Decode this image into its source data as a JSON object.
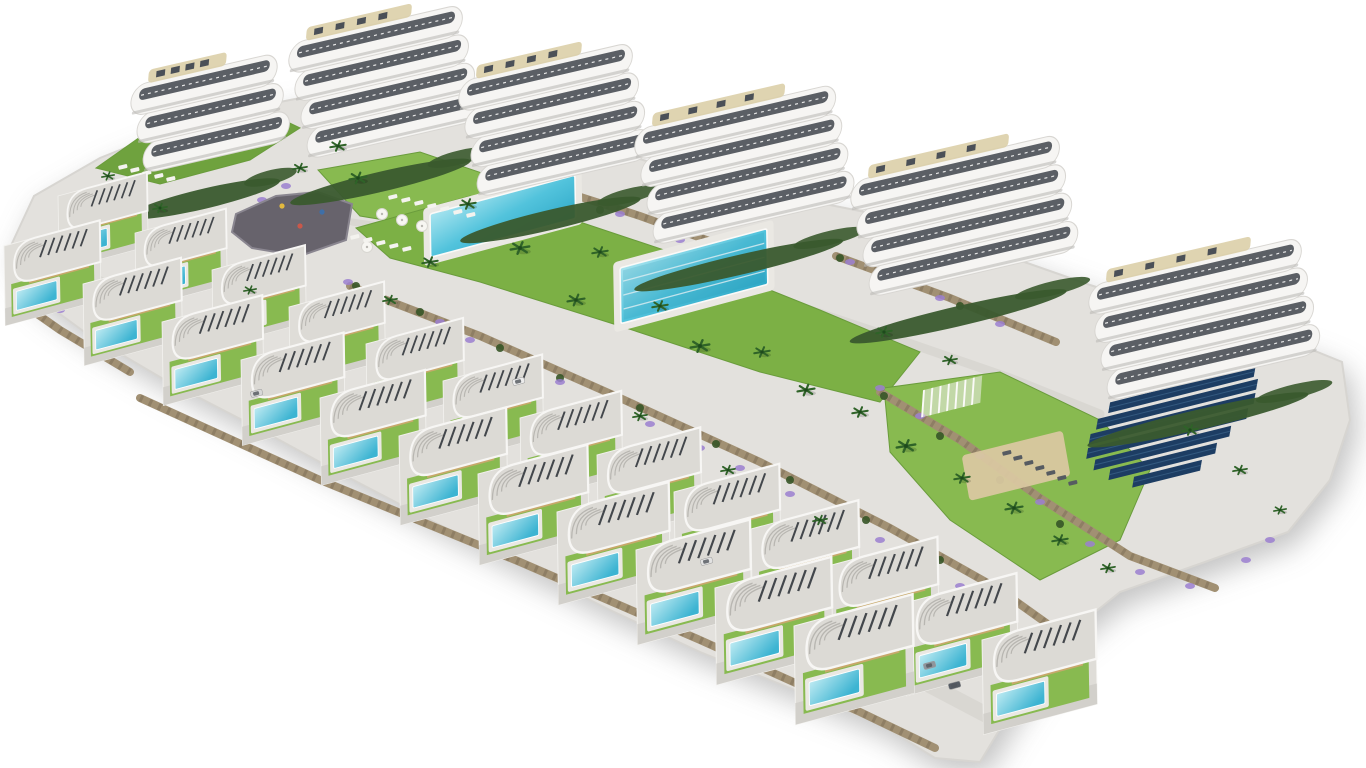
{
  "scene": {
    "name": "aerial-render-residential-resort-complex",
    "background": "#ffffff",
    "colors": {
      "terrain": "#e3e1dd",
      "terrain_edge": "#d7d5d1",
      "road": "#d9d7d2",
      "path": "#e7e5e1",
      "lawn": "#7cb045",
      "lawn_bright": "#88ba50",
      "lawn_slope": "#6fa23e",
      "hedge": "#3a5a2e",
      "palm": "#2f6328",
      "shrub": "#365527",
      "flower": "#9b7fd0",
      "wall": "#a19073",
      "wall_dark": "#7f7058",
      "slab_white": "#f6f5f3",
      "slab_stroke": "#d8d6d2",
      "window_dark": "#454a51",
      "roof_deck": "#dccfa8",
      "villa_roof": "#dcdad5",
      "villa_roof_rim": "#f7f6f4",
      "villa_wall": "#c7a86b",
      "villa_plot": "#dfddd8",
      "villa_drive": "#d2d0cb",
      "louvre": "#43474c",
      "pool_light": "#a8e4ef",
      "pool_mid": "#52c3dc",
      "pool_deep": "#2fa9c8",
      "pool_deck": "#eae8e3",
      "plaza": "#67636c",
      "sand": "#d9c7a0",
      "solar": "#1d3d63",
      "solar_line": "#33597f"
    },
    "terrain_outline": [
      [
        8,
        252
      ],
      [
        34,
        196
      ],
      [
        100,
        158
      ],
      [
        150,
        138
      ],
      [
        230,
        112
      ],
      [
        310,
        96
      ],
      [
        400,
        96
      ],
      [
        480,
        120
      ],
      [
        575,
        140
      ],
      [
        660,
        165
      ],
      [
        780,
        195
      ],
      [
        880,
        215
      ],
      [
        990,
        250
      ],
      [
        1090,
        285
      ],
      [
        1200,
        320
      ],
      [
        1300,
        345
      ],
      [
        1342,
        362
      ],
      [
        1350,
        420
      ],
      [
        1330,
        480
      ],
      [
        1288,
        532
      ],
      [
        1205,
        562
      ],
      [
        1120,
        592
      ],
      [
        1058,
        642
      ],
      [
        1010,
        712
      ],
      [
        980,
        762
      ],
      [
        935,
        758
      ],
      [
        880,
        724
      ],
      [
        790,
        688
      ],
      [
        700,
        652
      ],
      [
        610,
        610
      ],
      [
        520,
        565
      ],
      [
        430,
        520
      ],
      [
        340,
        473
      ],
      [
        250,
        424
      ],
      [
        165,
        380
      ],
      [
        90,
        336
      ],
      [
        30,
        292
      ]
    ],
    "roads": [
      {
        "name": "villa-street",
        "width": 16,
        "points": [
          [
            55,
            262
          ],
          [
            210,
            340
          ],
          [
            400,
            432
          ],
          [
            590,
            522
          ],
          [
            770,
            608
          ],
          [
            905,
            672
          ],
          [
            1000,
            722
          ]
        ]
      },
      {
        "name": "garden-path",
        "width": 9,
        "points": [
          [
            300,
            196
          ],
          [
            420,
            196
          ],
          [
            540,
            226
          ],
          [
            660,
            262
          ],
          [
            780,
            300
          ],
          [
            900,
            340
          ],
          [
            1010,
            378
          ],
          [
            1100,
            414
          ]
        ]
      },
      {
        "name": "plaza-path",
        "width": 7,
        "points": [
          [
            352,
            222
          ],
          [
            420,
            232
          ],
          [
            470,
            250
          ]
        ]
      }
    ],
    "lawns": [
      {
        "name": "slope-lawn-northwest",
        "tone": "lawn_slope",
        "points": [
          [
            96,
            168
          ],
          [
            150,
            130
          ],
          [
            250,
            104
          ],
          [
            300,
            128
          ],
          [
            250,
            160
          ],
          [
            160,
            184
          ]
        ]
      },
      {
        "name": "loungers-lawn",
        "tone": "lawn_bright",
        "points": [
          [
            318,
            170
          ],
          [
            420,
            152
          ],
          [
            520,
            186
          ],
          [
            470,
            234
          ],
          [
            360,
            216
          ]
        ]
      },
      {
        "name": "central-garden-lawn",
        "tone": "lawn",
        "points": [
          [
            356,
            228
          ],
          [
            470,
            196
          ],
          [
            580,
            222
          ],
          [
            700,
            262
          ],
          [
            820,
            310
          ],
          [
            920,
            352
          ],
          [
            880,
            402
          ],
          [
            760,
            372
          ],
          [
            620,
            326
          ],
          [
            480,
            282
          ],
          [
            390,
            258
          ]
        ]
      },
      {
        "name": "east-garden-lawn",
        "tone": "lawn_bright",
        "points": [
          [
            884,
            388
          ],
          [
            1000,
            372
          ],
          [
            1100,
            420
          ],
          [
            1150,
            470
          ],
          [
            1120,
            540
          ],
          [
            1040,
            580
          ],
          [
            950,
            520
          ],
          [
            890,
            452
          ]
        ]
      }
    ],
    "walls": [
      {
        "points": [
          [
            10,
            295
          ],
          [
            60,
            330
          ],
          [
            130,
            372
          ]
        ]
      },
      {
        "points": [
          [
            350,
            286
          ],
          [
            480,
            336
          ],
          [
            620,
            398
          ],
          [
            760,
            462
          ],
          [
            890,
            528
          ],
          [
            1000,
            590
          ],
          [
            1070,
            640
          ]
        ]
      },
      {
        "points": [
          [
            540,
            184
          ],
          [
            640,
            216
          ],
          [
            740,
            252
          ]
        ]
      },
      {
        "points": [
          [
            836,
            256
          ],
          [
            950,
            298
          ],
          [
            1056,
            342
          ]
        ]
      },
      {
        "points": [
          [
            880,
            392
          ],
          [
            960,
            440
          ],
          [
            1040,
            498
          ],
          [
            1130,
            556
          ],
          [
            1215,
            588
          ]
        ]
      },
      {
        "points": [
          [
            140,
            398
          ],
          [
            320,
            480
          ],
          [
            520,
            562
          ],
          [
            700,
            640
          ],
          [
            860,
            712
          ],
          [
            935,
            748
          ]
        ]
      }
    ],
    "plaza": {
      "points": [
        [
          236,
          214
        ],
        [
          276,
          196
        ],
        [
          318,
          192
        ],
        [
          352,
          204
        ],
        [
          346,
          240
        ],
        [
          300,
          256
        ],
        [
          252,
          248
        ],
        [
          232,
          232
        ]
      ],
      "toys": [
        [
          282,
          206,
          "#e3b93e"
        ],
        [
          300,
          226,
          "#c9584a"
        ],
        [
          322,
          212,
          "#3e6fa8"
        ]
      ]
    },
    "sand_court": {
      "x": 992,
      "y": 448,
      "w": 104,
      "h": 46
    },
    "pergola": {
      "x": 924,
      "y": 390,
      "w": 60,
      "h": 26,
      "slats": 7
    },
    "community_pools": [
      {
        "name": "community-pool",
        "x": 430,
        "y": 214,
        "w": 150,
        "h": 42,
        "lanes": 0
      },
      {
        "name": "lap-pool",
        "x": 620,
        "y": 268,
        "w": 152,
        "h": 54,
        "lanes": 3
      }
    ],
    "umbrellas": [
      [
        382,
        214
      ],
      [
        402,
        220
      ],
      [
        422,
        226
      ],
      [
        367,
        247
      ]
    ],
    "lounger_rows": [
      {
        "x": 388,
        "y": 196,
        "count": 7,
        "step": [
          13,
          3
        ],
        "color": "#f4f3ef"
      },
      {
        "x": 350,
        "y": 236,
        "count": 5,
        "step": [
          13,
          3
        ],
        "color": "#f4f3ef"
      },
      {
        "x": 1002,
        "y": 452,
        "count": 7,
        "step": [
          11,
          5
        ],
        "color": "#565b61"
      },
      {
        "x": 118,
        "y": 166,
        "count": 5,
        "step": [
          12,
          3
        ],
        "color": "#f4f3ef"
      }
    ],
    "solar_array": {
      "x": 1098,
      "y": 392,
      "bars": [
        {
          "dx": 30,
          "len": 120
        },
        {
          "dx": 15,
          "len": 150
        },
        {
          "dx": 5,
          "len": 165
        },
        {
          "dx": 0,
          "len": 170
        },
        {
          "dx": 0,
          "len": 165
        },
        {
          "dx": 10,
          "len": 140
        },
        {
          "dx": 28,
          "len": 110
        },
        {
          "dx": 55,
          "len": 70
        }
      ]
    },
    "apartment_buildings": [
      {
        "x": 142,
        "y": 172,
        "w": 150,
        "floors": 3
      },
      {
        "x": 306,
        "y": 158,
        "w": 178,
        "floors": 4
      },
      {
        "x": 476,
        "y": 196,
        "w": 178,
        "floors": 4
      },
      {
        "x": 652,
        "y": 244,
        "w": 206,
        "floors": 4
      },
      {
        "x": 868,
        "y": 296,
        "w": 214,
        "floors": 4
      },
      {
        "x": 1106,
        "y": 400,
        "w": 218,
        "floors": 4
      }
    ],
    "villa_rows": [
      {
        "name": "villa-row-upper",
        "start": [
          58,
          196
        ],
        "step": [
          77,
          37
        ],
        "count": 13,
        "scale0": 0.78,
        "scaleStep": 0.018
      },
      {
        "name": "villa-row-lower",
        "start": [
          4,
          246
        ],
        "step": [
          79,
          38
        ],
        "count": 11,
        "scale0": 0.84,
        "scaleStep": 0.02
      }
    ],
    "cars": [
      {
        "x": 512,
        "y": 380,
        "c": "#ececec"
      },
      {
        "x": 250,
        "y": 392,
        "c": "#d8d8d8"
      },
      {
        "x": 923,
        "y": 664,
        "c": "#8f959c"
      },
      {
        "x": 948,
        "y": 684,
        "c": "#565c64"
      },
      {
        "x": 700,
        "y": 560,
        "c": "#e2e2e2"
      }
    ],
    "palms": [
      [
        338,
        146,
        1
      ],
      [
        358,
        178,
        1.1
      ],
      [
        300,
        168,
        0.9
      ],
      [
        468,
        204,
        1
      ],
      [
        520,
        248,
        1.2
      ],
      [
        600,
        252,
        1
      ],
      [
        576,
        300,
        1.1
      ],
      [
        660,
        306,
        1
      ],
      [
        700,
        346,
        1.2
      ],
      [
        762,
        352,
        1
      ],
      [
        806,
        390,
        1.1
      ],
      [
        860,
        412,
        1
      ],
      [
        906,
        446,
        1.2
      ],
      [
        962,
        478,
        1
      ],
      [
        1014,
        508,
        1.1
      ],
      [
        1060,
        540,
        1
      ],
      [
        1108,
        568,
        0.9
      ],
      [
        430,
        262,
        1
      ],
      [
        390,
        300,
        0.9
      ],
      [
        250,
        290,
        0.8
      ],
      [
        160,
        208,
        0.9
      ],
      [
        108,
        176,
        0.8
      ],
      [
        884,
        332,
        1
      ],
      [
        950,
        360,
        0.9
      ],
      [
        1190,
        430,
        1
      ],
      [
        1240,
        470,
        0.9
      ],
      [
        1280,
        510,
        0.8
      ],
      [
        640,
        416,
        0.9
      ],
      [
        728,
        470,
        0.9
      ],
      [
        820,
        520,
        0.9
      ]
    ],
    "shrubs": [
      [
        356,
        286
      ],
      [
        420,
        312
      ],
      [
        500,
        348
      ],
      [
        560,
        378
      ],
      [
        640,
        408
      ],
      [
        716,
        444
      ],
      [
        790,
        480
      ],
      [
        866,
        520
      ],
      [
        940,
        560
      ],
      [
        1010,
        600
      ],
      [
        540,
        188
      ],
      [
        600,
        210
      ],
      [
        660,
        232
      ],
      [
        840,
        258
      ],
      [
        900,
        280
      ],
      [
        960,
        306
      ],
      [
        884,
        396
      ],
      [
        940,
        436
      ],
      [
        1000,
        480
      ],
      [
        1060,
        524
      ],
      [
        60,
        300
      ],
      [
        110,
        340
      ],
      [
        170,
        372
      ]
    ],
    "flowers": [
      [
        348,
        282
      ],
      [
        380,
        298
      ],
      [
        440,
        322
      ],
      [
        470,
        340
      ],
      [
        530,
        362
      ],
      [
        560,
        382
      ],
      [
        610,
        402
      ],
      [
        650,
        424
      ],
      [
        700,
        448
      ],
      [
        740,
        468
      ],
      [
        790,
        494
      ],
      [
        830,
        516
      ],
      [
        880,
        540
      ],
      [
        920,
        562
      ],
      [
        960,
        586
      ],
      [
        540,
        180
      ],
      [
        570,
        196
      ],
      [
        620,
        214
      ],
      [
        680,
        240
      ],
      [
        850,
        262
      ],
      [
        890,
        278
      ],
      [
        940,
        298
      ],
      [
        1000,
        324
      ],
      [
        880,
        388
      ],
      [
        920,
        416
      ],
      [
        980,
        456
      ],
      [
        1040,
        502
      ],
      [
        1090,
        544
      ],
      [
        1140,
        572
      ],
      [
        1190,
        586
      ],
      [
        250,
        270
      ],
      [
        210,
        254
      ],
      [
        60,
        310
      ],
      [
        100,
        342
      ],
      [
        286,
        186
      ],
      [
        262,
        200
      ],
      [
        1246,
        560
      ],
      [
        1270,
        540
      ]
    ]
  }
}
